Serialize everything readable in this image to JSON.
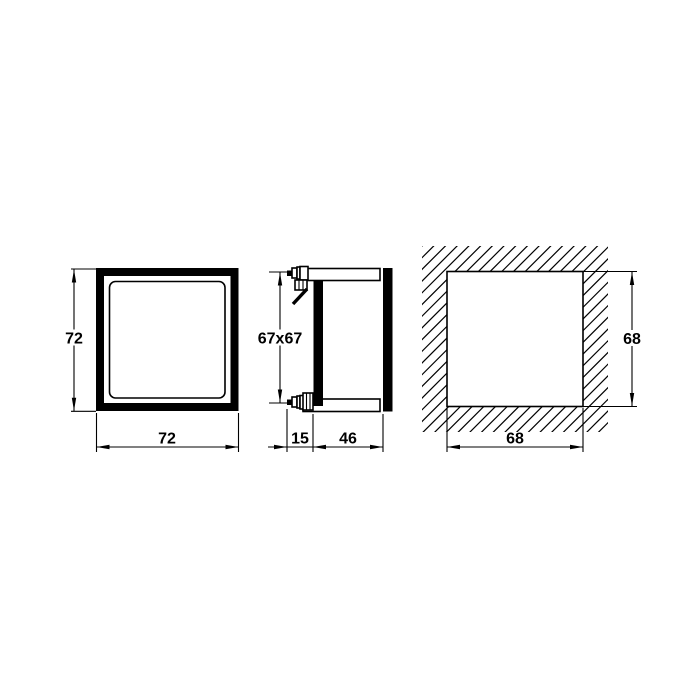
{
  "views": {
    "front": {
      "height_label": "72",
      "width_label": "72"
    },
    "side": {
      "face_label": "67x67",
      "clamp_depth_label": "15",
      "body_depth_label": "46"
    },
    "panel_cutout": {
      "height_label": "68",
      "width_label": "68"
    }
  },
  "colors": {
    "line": "#000000",
    "background": "#ffffff"
  }
}
